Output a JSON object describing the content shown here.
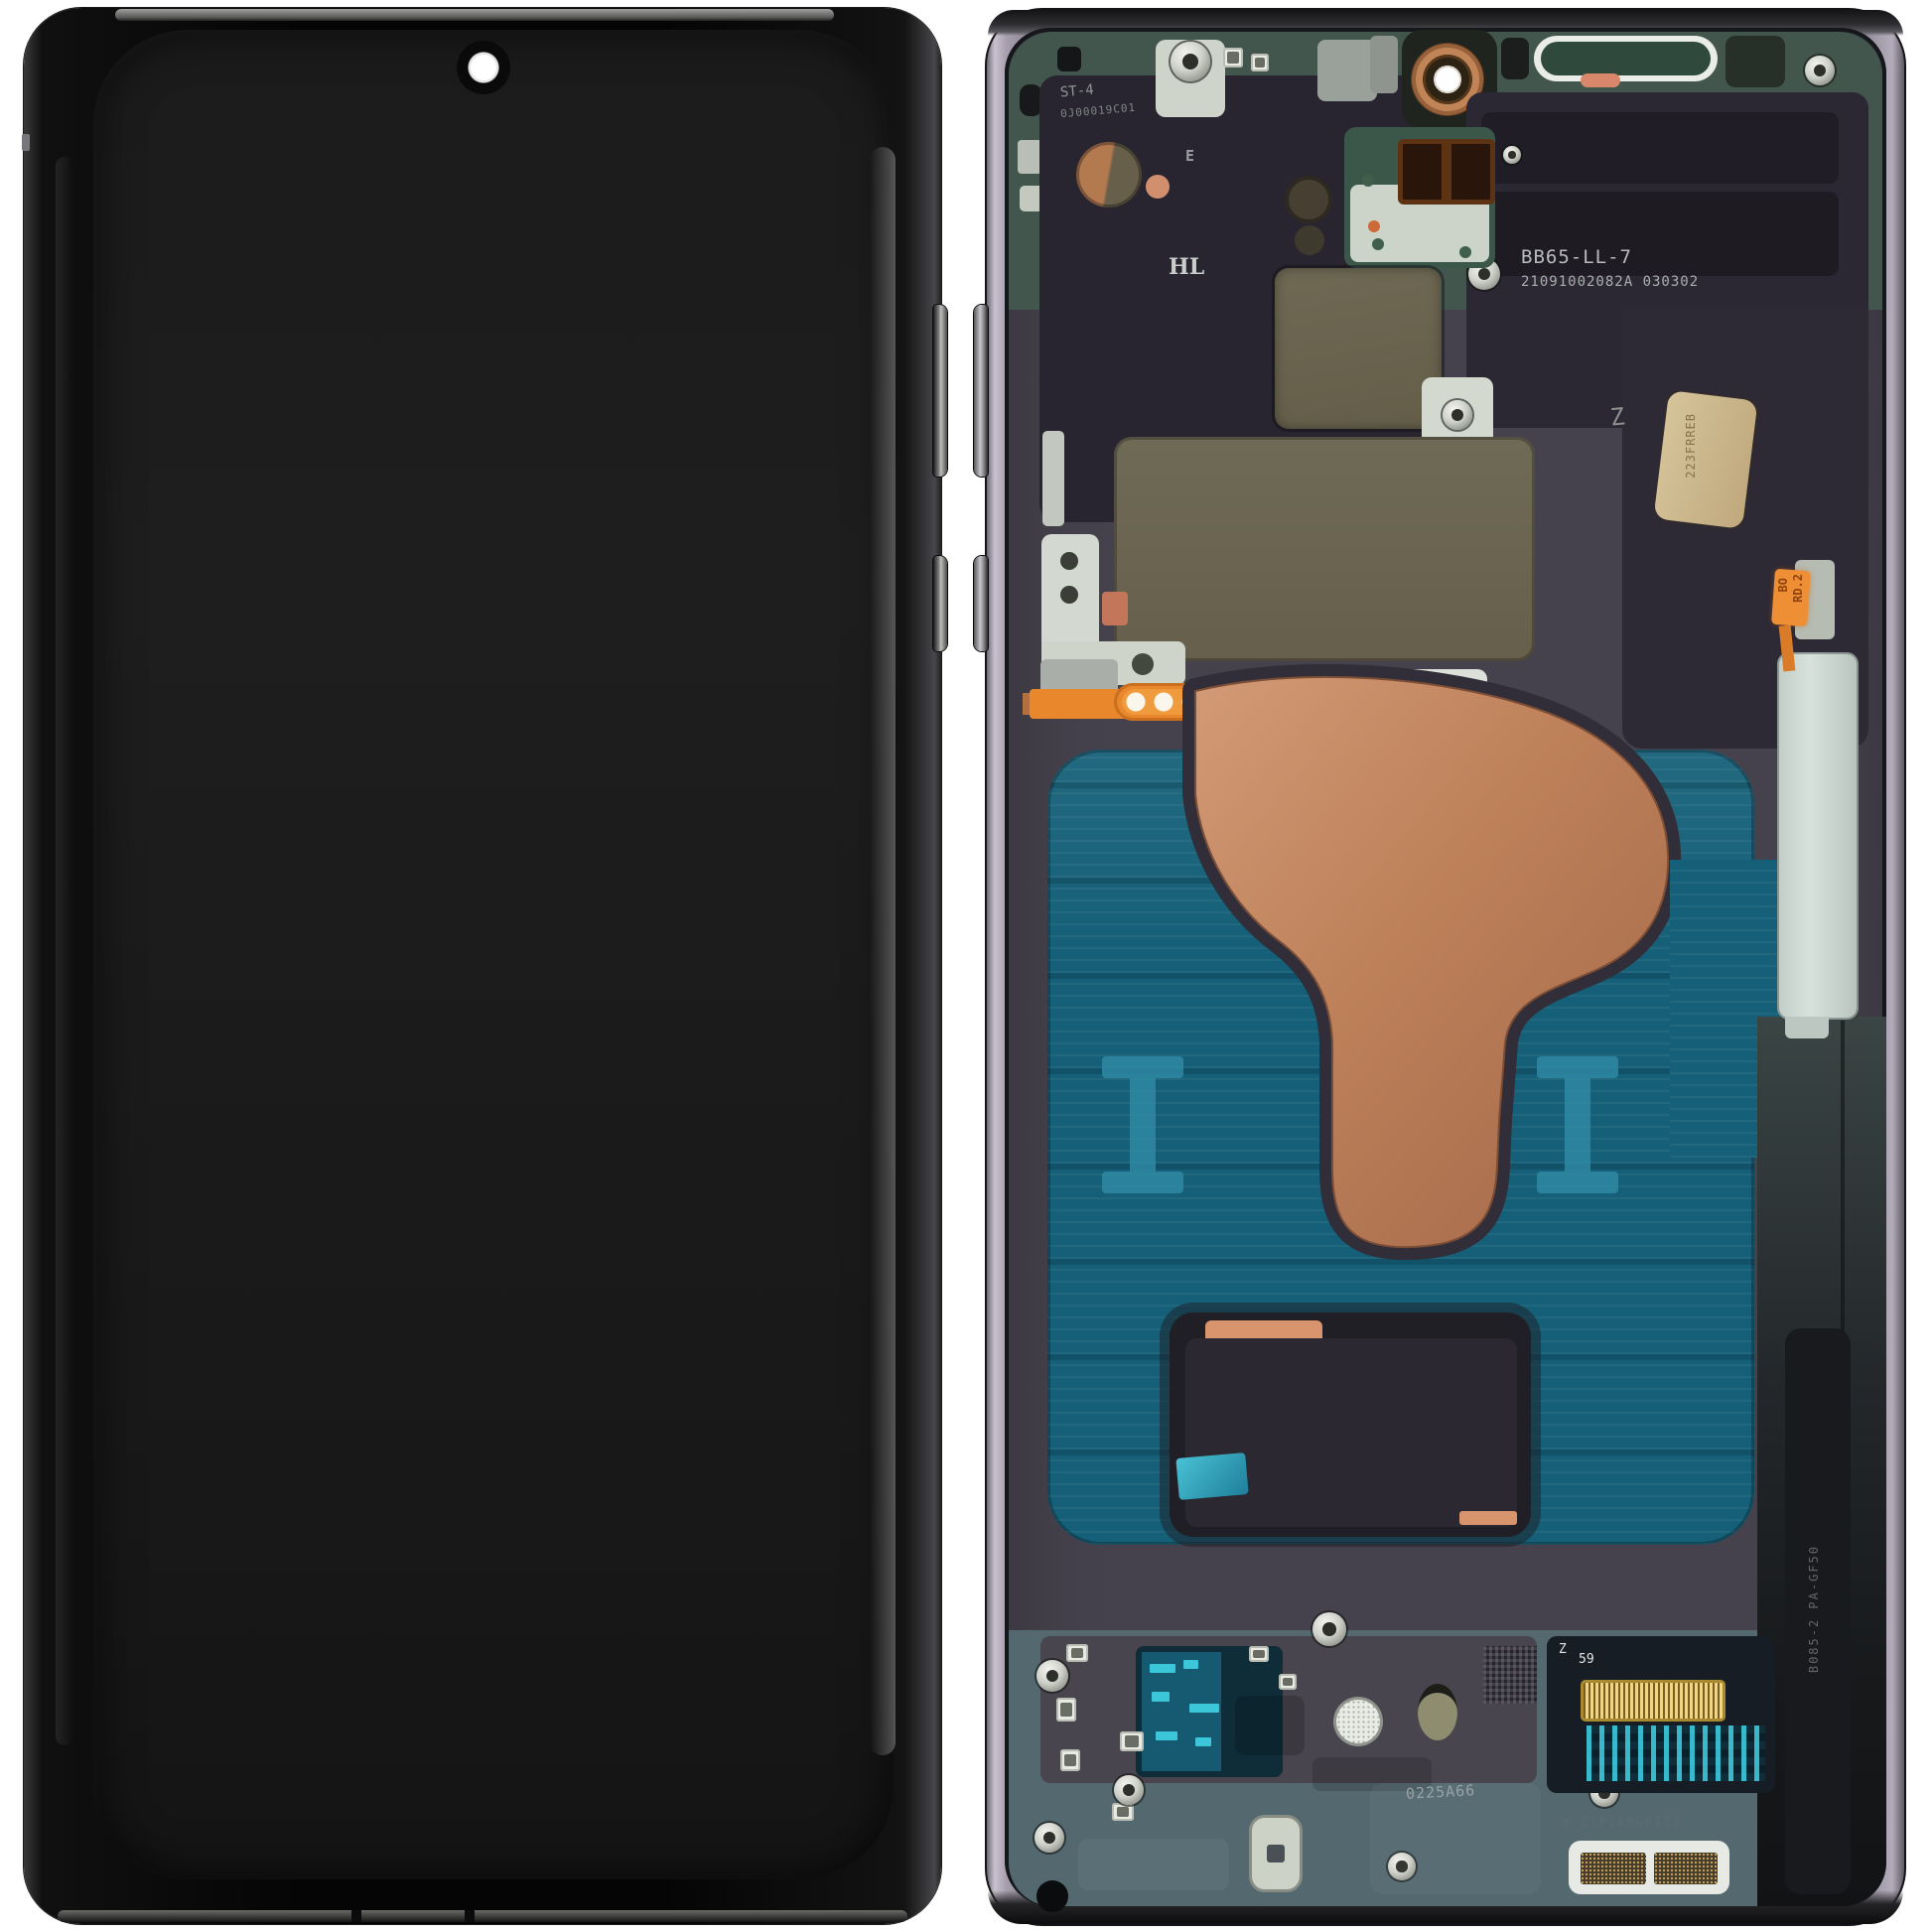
{
  "photo": {
    "background_color": "#ffffff"
  },
  "front_view": {
    "screen_color": "#1a1a1a",
    "body_color": "#0a0a0a"
  },
  "back_view": {
    "frame_color": "#a9a2b0",
    "chassis_teal": "#42564d",
    "chassis_purple": "#46424d",
    "graphite": "#2a2630",
    "khaki_pad": "#6c664f",
    "copper_flex": "#bb7f5c",
    "blue_adhesive": "#156078",
    "orange_flex": "#e8872c",
    "mint_plate": "#ced8d2",
    "gold_connector": "#d4b258",
    "bottom_casting": "#54696f",
    "markings": {
      "top_label": "ST-4",
      "top_serial": "0J00019C01",
      "hl_stamp": "HL",
      "e_stamp": "E",
      "model_code": "BB65-LL-7",
      "mid_serial": "21091002082A 030302",
      "z_stamp": "Z",
      "flex_tag": "223FRREB",
      "orange_sticker_line1": "BO",
      "orange_sticker_line2": "RD.2",
      "rail_molding": "B085-2 PA-GF50",
      "connector_z": "Z",
      "connector_num": "59",
      "bottom_stamp": "0225A66",
      "board_serial": "⊕ 61F2BRGF45Z"
    }
  }
}
